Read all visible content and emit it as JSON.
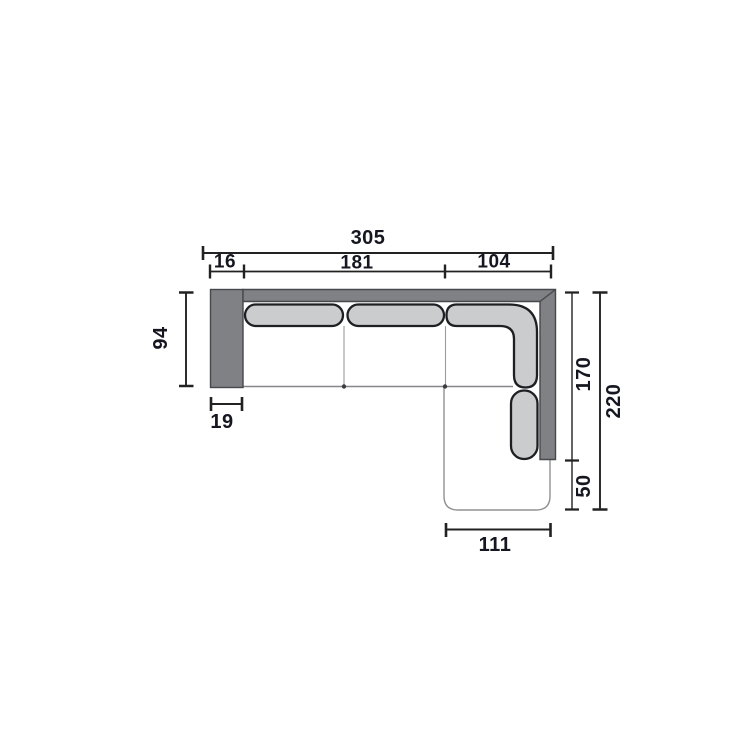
{
  "diagram": {
    "type": "furniture-plan-dimension-drawing",
    "subject": "corner-sofa-top-view",
    "dimensions": {
      "overall_width": "305",
      "back_segment_left": "16",
      "back_segment_middle": "181",
      "back_segment_right": "104",
      "body_depth": "94",
      "armrest_width": "19",
      "right_side_upper": "170",
      "right_side_lower": "50",
      "overall_depth": "220",
      "chaise_width": "111"
    },
    "colors": {
      "frame_gray": "#7f8185",
      "frame_border": "#47484c",
      "cushion_gray": "#cbccce",
      "cushion_outline": "#1e1f23",
      "thin_outline": "#909194",
      "dimension_line": "#222222",
      "label_text": "#15161f",
      "background": "#ffffff"
    }
  }
}
